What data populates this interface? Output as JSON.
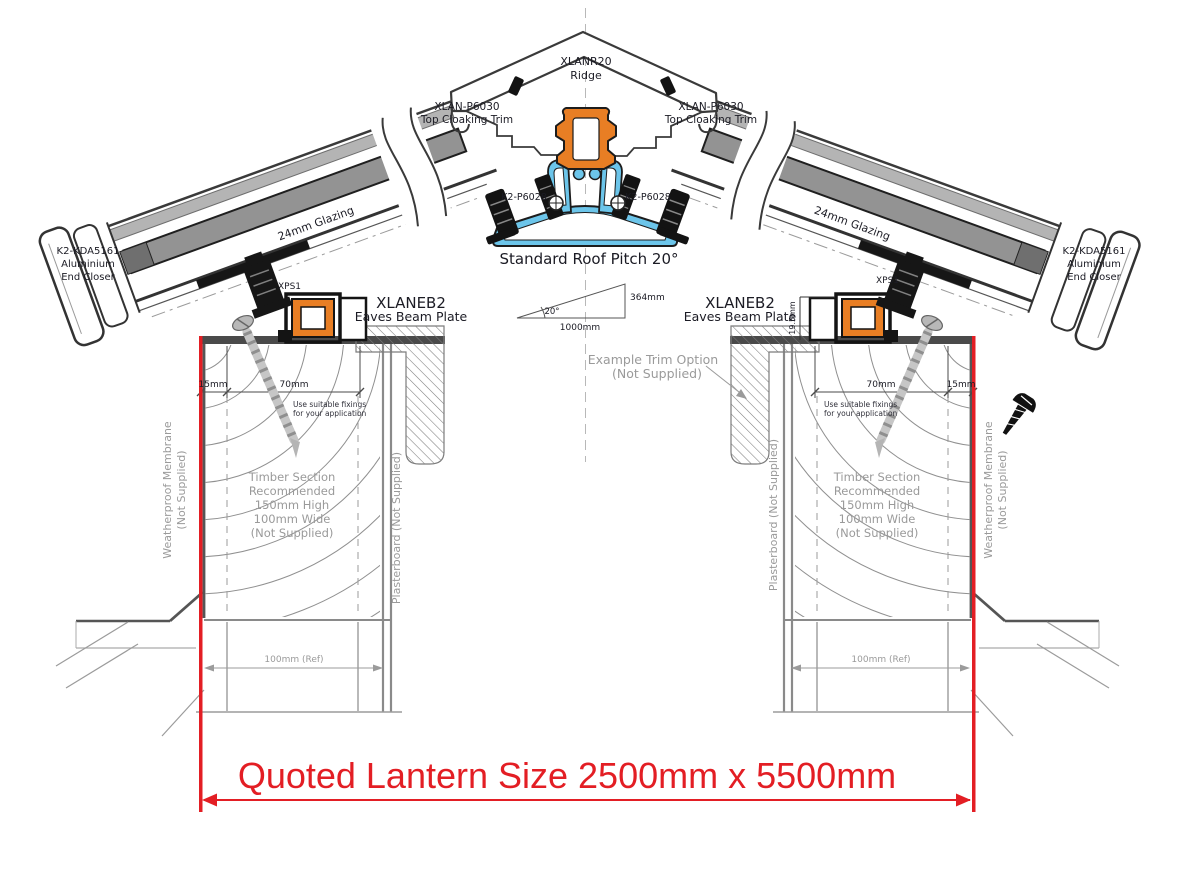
{
  "page": {
    "width": 1184,
    "height": 872,
    "background": "#ffffff"
  },
  "quote": {
    "label": "Quoted Lantern Size 2500mm x 5500mm",
    "color": "#e31e24"
  },
  "ridge": {
    "code": "XLANR20",
    "name": "Ridge"
  },
  "cloaking": {
    "left": {
      "code": "XLAN-P6030",
      "name": "Top Cloaking Trim"
    },
    "right": {
      "code": "XLAN-P6030",
      "name": "Top Cloaking Trim"
    }
  },
  "ridge_fixings": {
    "left": "K2-P6028",
    "right": "K2-P6028"
  },
  "pitch": {
    "label": "Standard Roof Pitch 20°",
    "angle": "20°",
    "run": "1000mm",
    "rise": "364mm"
  },
  "rafters": {
    "left_glazing": "24mm Glazing",
    "right_glazing": "24mm Glazing"
  },
  "end_closers": {
    "left": [
      "K2-KDA5161",
      "Aluminium",
      "End Closer"
    ],
    "right": [
      "K2-KDA5161",
      "Aluminium",
      "End Closer"
    ]
  },
  "eaves": {
    "left": {
      "code": "XLANEB2",
      "name": "Eaves Beam Plate",
      "packer": "XPS1"
    },
    "right": {
      "code": "XLANEB2",
      "name": "Eaves Beam Plate",
      "packer": "XPS1",
      "upstand_height": "19.5mm"
    }
  },
  "trim_option": [
    "Example Trim Option",
    "(Not Supplied)"
  ],
  "walls": {
    "left": {
      "offset": "15mm",
      "width_dim": "70mm",
      "fixing_note": [
        "Use suitable fixings",
        "for your application"
      ],
      "timber_note": [
        "Timber Section",
        "Recommended",
        "150mm High",
        "100mm Wide",
        "(Not Supplied)"
      ],
      "membrane": [
        "Weatherproof Membrane",
        "(Not Supplied)"
      ],
      "plasterboard": "Plasterboard (Not Supplied)",
      "base_ref": "100mm (Ref)"
    },
    "right": {
      "offset": "15mm",
      "width_dim": "70mm",
      "fixing_note": [
        "Use suitable fixings",
        "for your application"
      ],
      "timber_note": [
        "Timber Section",
        "Recommended",
        "150mm High",
        "100mm Wide",
        "(Not Supplied)"
      ],
      "membrane": [
        "Weatherproof Membrane",
        "(Not Supplied)"
      ],
      "plasterboard": "Plasterboard (Not Supplied)",
      "base_ref": "100mm (Ref)"
    }
  },
  "colors": {
    "accent_red": "#e31e24",
    "profile_orange": "#e87e24",
    "profile_blue": "#6cc5ea"
  }
}
